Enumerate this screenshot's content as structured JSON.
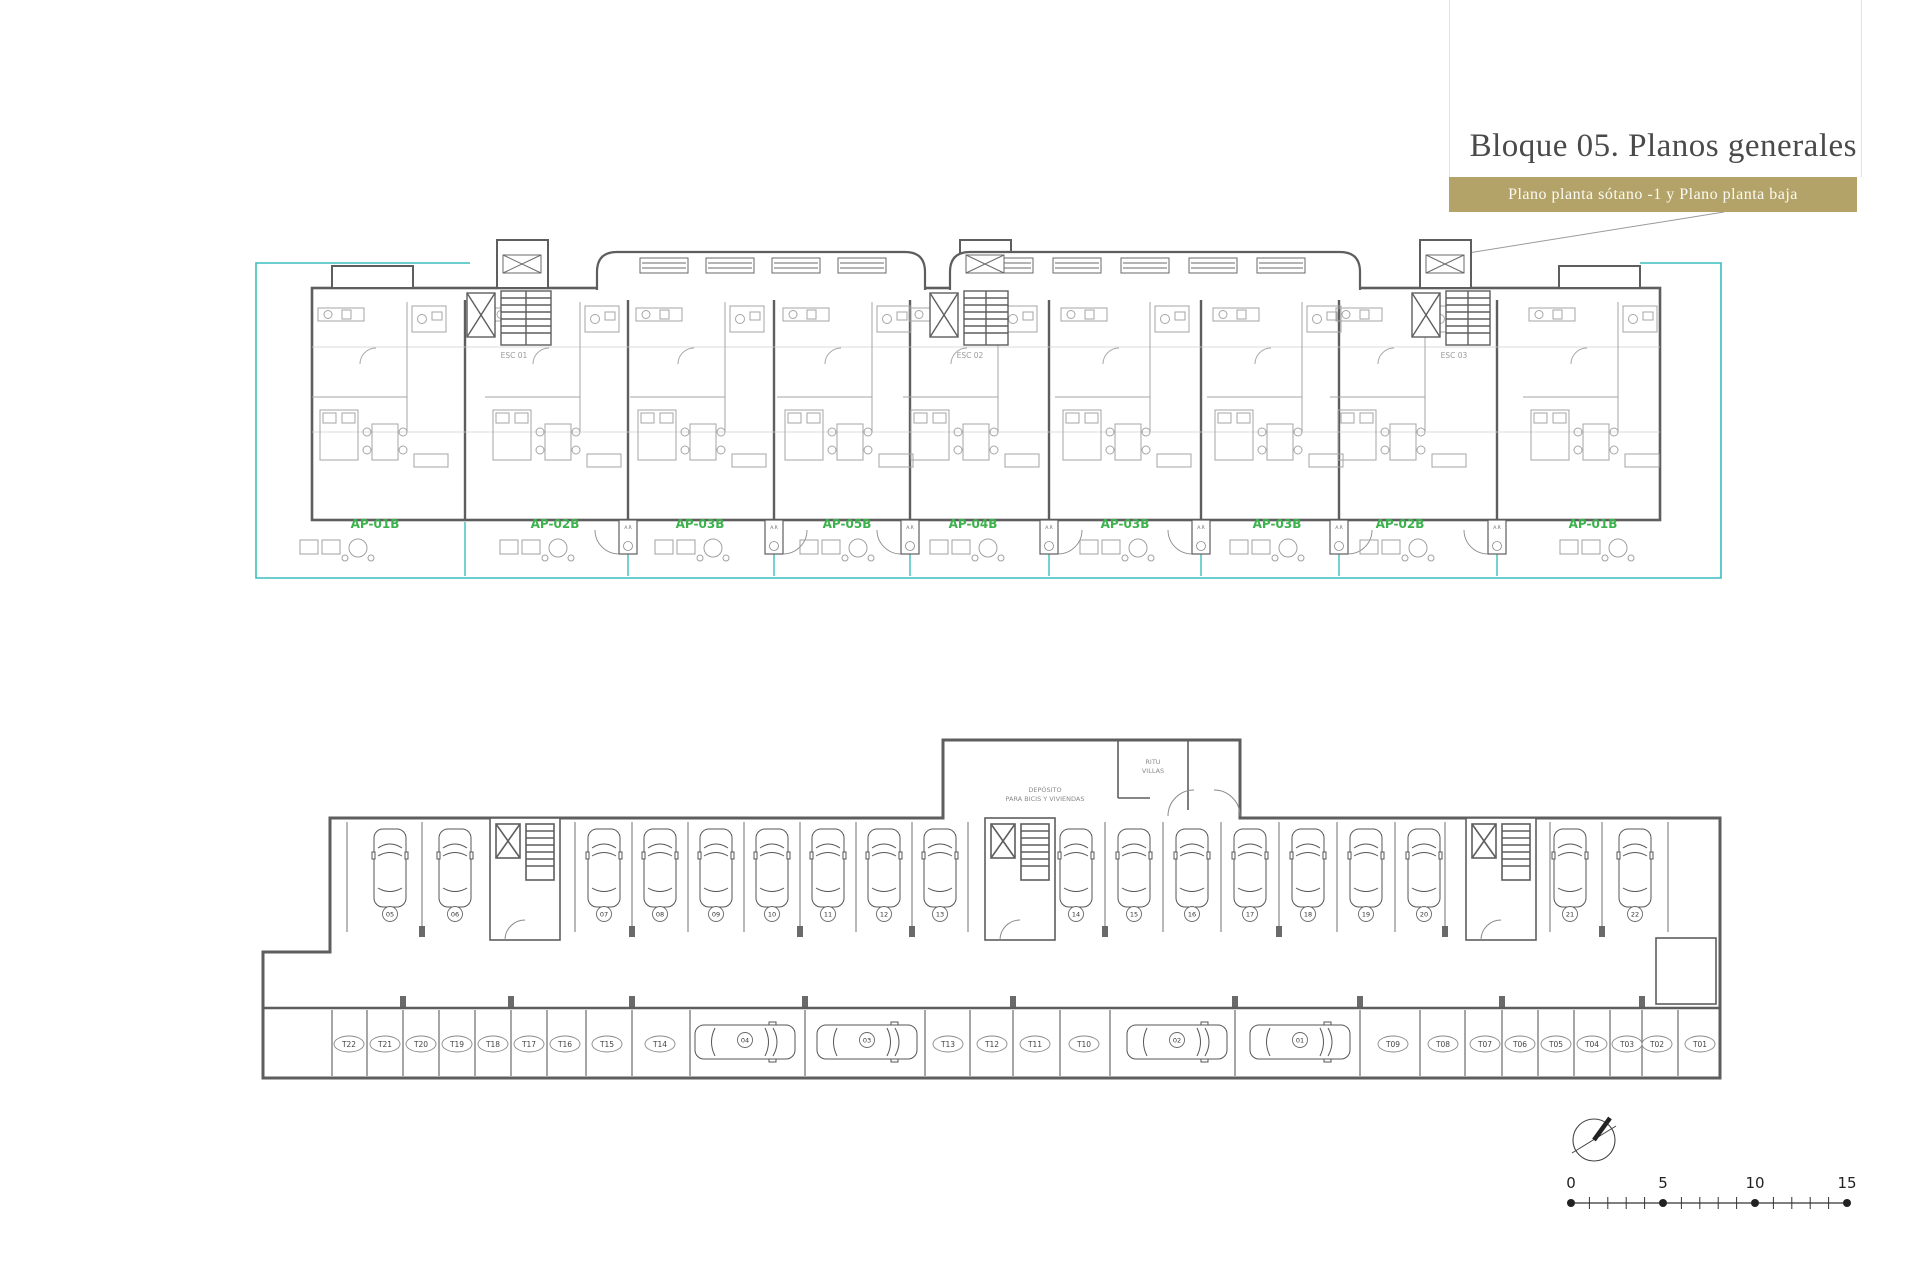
{
  "header": {
    "title": "Bloque 05. Planos generales",
    "subtitle": "Plano planta sótano -1 y Plano planta baja"
  },
  "ground_floor": {
    "apartment_labels": [
      "AP-01B",
      "AP-02B",
      "AP-03B",
      "AP-05B",
      "AP-04B",
      "AP-03B",
      "AP-03B",
      "AP-02B",
      "AP-01B"
    ],
    "stair_labels": [
      "ESC 01",
      "ESC 02",
      "ESC 03"
    ],
    "riser_label": "A.R"
  },
  "basement": {
    "deposit_line1": "DEPÓSITO",
    "deposit_line2": "PARA BICIS Y VIVIENDAS",
    "ritu_line1": "RITU",
    "ritu_line2": "VILLAS",
    "parking_numbers": [
      "05",
      "06",
      "07",
      "08",
      "09",
      "10",
      "11",
      "12",
      "13",
      "14",
      "15",
      "16",
      "17",
      "18",
      "19",
      "20",
      "21",
      "22"
    ],
    "aisle_parking_numbers": [
      "04",
      "03",
      "02",
      "01"
    ],
    "storage_labels": [
      "T22",
      "T21",
      "T20",
      "T19",
      "T18",
      "T17",
      "T16",
      "T15",
      "T14",
      "T13",
      "T12",
      "T11",
      "T10",
      "T09",
      "T08",
      "T07",
      "T06",
      "T05",
      "T04",
      "T03",
      "T02",
      "T01"
    ]
  },
  "scale_bar": {
    "labels": [
      "0",
      "5",
      "10",
      "15"
    ]
  },
  "colors": {
    "accent_gold": "#b3a369",
    "plan_teal": "#3cbdbd",
    "apartment_green": "#3cb24c",
    "wall_gray": "#5e5e5e"
  }
}
